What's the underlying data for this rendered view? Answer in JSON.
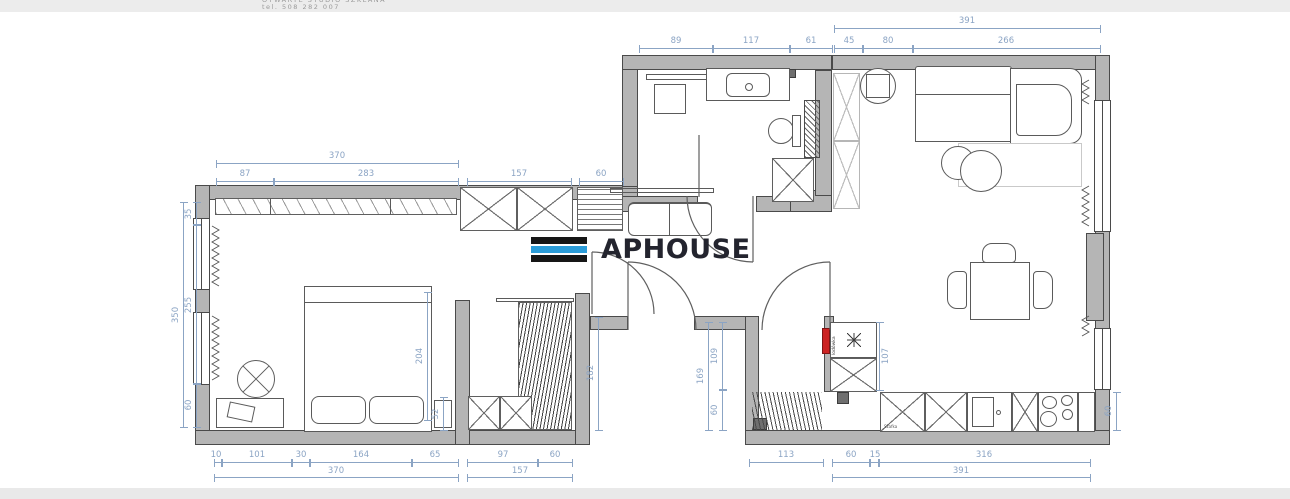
{
  "header": {
    "studio_line": "OTWARTE STUDIO SZKLANA",
    "phone_line": "tel. 508 282 007"
  },
  "watermark": {
    "brand": "APHOUSE",
    "bar_top_color": "#161616",
    "bar_mid_color": "#2b9cd8",
    "bar_bottom_color": "#161616"
  },
  "colors": {
    "wall_fill": "#b5b5b5",
    "wall_stroke": "#4a4a4a",
    "dimension": "#8ba4c4",
    "furniture_stroke": "#5a5a5a",
    "radiator_red": "#cc2222"
  },
  "plan_labels": {
    "fridge": "lodówka",
    "kitchen_cabinet": "Szafka"
  },
  "dims": {
    "bath_89": "89",
    "bath_117": "117",
    "bath_61": "61",
    "liv_total": "391",
    "liv_45": "45",
    "liv_80": "80",
    "liv_266": "266",
    "bed_total_top": "370",
    "bed_87": "87",
    "bed_283": "283",
    "corr_157": "157",
    "corr_60": "60",
    "left_total": "350",
    "left_35": "35",
    "left_255": "255",
    "left_60": "60",
    "bl_10": "10",
    "bl_101": "101",
    "bl_30": "30",
    "bl_164": "164",
    "bl_65": "65",
    "bl_total": "370",
    "bm_97": "97",
    "bm_60": "60",
    "bm_total": "157",
    "br_113": "113",
    "br_60": "60",
    "br_15": "15",
    "br_316": "316",
    "br_total": "391",
    "right_60": "60",
    "hall_total": "169",
    "hall_109": "109",
    "hall_60": "60",
    "fridge_107": "107",
    "bed_204": "204",
    "bed_52": "52",
    "ward_182": "182"
  }
}
